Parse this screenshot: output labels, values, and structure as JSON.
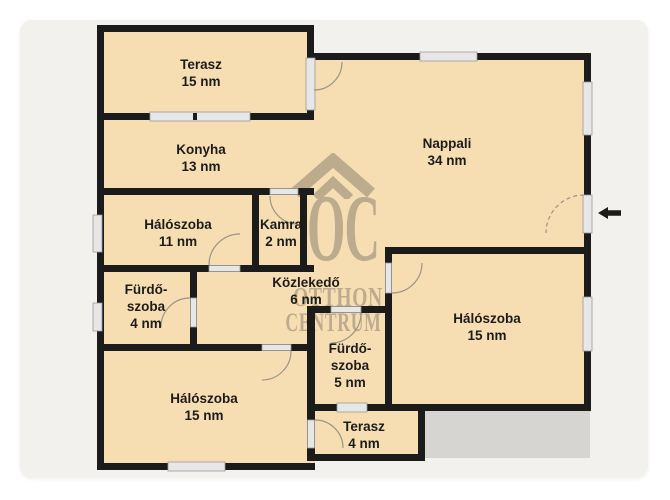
{
  "page": {
    "colors": {
      "page_bg": "#ffffff",
      "card": "#f2f1ee"
    }
  },
  "floorplan": {
    "unit": "nm",
    "colors": {
      "floor": "#f6deb2",
      "wall": "#1b1b1b",
      "opening": "#e7e7e7",
      "opening_border": "#9a9a9a",
      "door_arc": "#9a9488",
      "watermark": "#8d8270",
      "slab": "#d7d5d2",
      "label": "#1c1c1c"
    },
    "rooms": [
      {
        "id": "terasz-felso",
        "lines": [
          "Terasz",
          "15 nm"
        ]
      },
      {
        "id": "konyha",
        "lines": [
          "Konyha",
          "13 nm"
        ]
      },
      {
        "id": "nappali",
        "lines": [
          "Nappali",
          "34 nm"
        ]
      },
      {
        "id": "haloszoba-11",
        "lines": [
          "Hálószoba",
          "11 nm"
        ]
      },
      {
        "id": "kamra",
        "lines": [
          "Kamra",
          "2 nm"
        ]
      },
      {
        "id": "kozlekedo",
        "lines": [
          "Közlekedő",
          "6 nm"
        ]
      },
      {
        "id": "furdoszoba-4",
        "lines": [
          "Fürdő-",
          "szoba",
          "4 nm"
        ]
      },
      {
        "id": "haloszoba-bal",
        "lines": [
          "Hálószoba",
          "15 nm"
        ]
      },
      {
        "id": "furdoszoba-5",
        "lines": [
          "Fürdő-",
          "szoba",
          "5 nm"
        ]
      },
      {
        "id": "haloszoba-jobb",
        "lines": [
          "Hálószoba",
          "15 nm"
        ]
      },
      {
        "id": "terasz-also",
        "lines": [
          "Terasz",
          "4 nm"
        ]
      }
    ],
    "watermark": {
      "monogram": "OC",
      "word1": "OTTHON",
      "word2": "CENTRUM"
    }
  }
}
